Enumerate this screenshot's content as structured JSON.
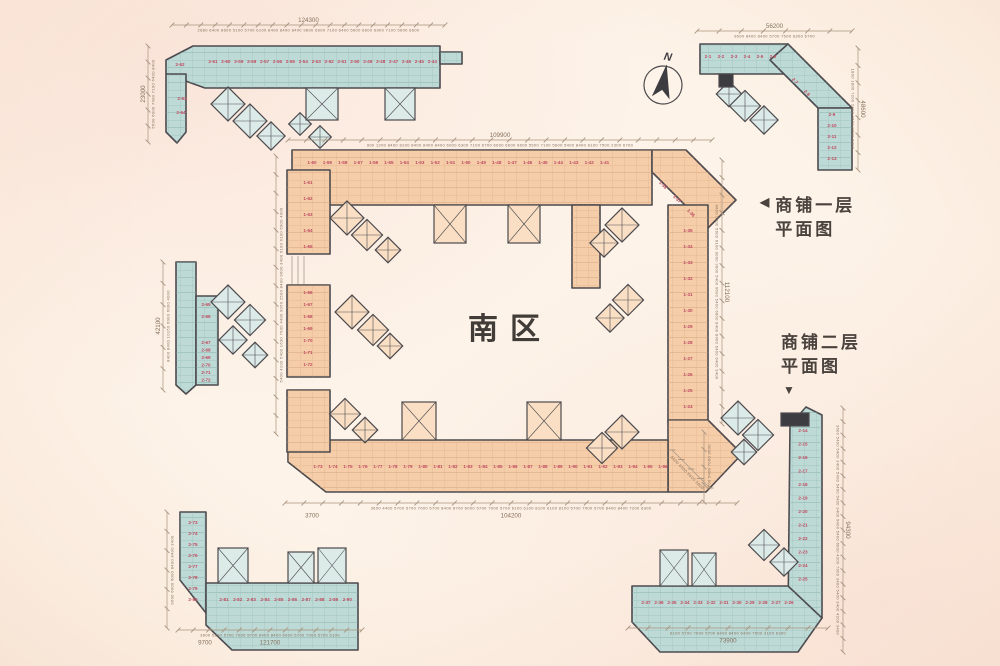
{
  "palette": {
    "teal_fill": "#bedad6",
    "teal_line": "#7ea9a4",
    "orange_fill": "#f5cda9",
    "orange_line": "#cf9d74",
    "teal_tower": "#dcebe8",
    "orange_tower": "#fadfc4",
    "wall": "#4c4a4e",
    "dark": "#3d3c40",
    "dim_text": "#86715d",
    "dim_line": "#a8937e",
    "unit_label": "#c04b60",
    "title": "#413c38"
  },
  "annotations": {
    "center_label": "南区",
    "legend1": {
      "arrow": "◀",
      "line1": "商铺一层",
      "line2": "平面图"
    },
    "legend2": {
      "line1": "商铺二层",
      "line2": "平面图",
      "arrow": "▼"
    },
    "compass_n": "N"
  },
  "plan": {
    "compass": {
      "x": 663,
      "y": 85,
      "r": 19,
      "tilt": 10
    },
    "extra_lines": [
      [
        292,
        256,
        292,
        284
      ],
      [
        298,
        256,
        298,
        284
      ],
      [
        304,
        256,
        304,
        284
      ]
    ],
    "buildings": [
      {
        "name": "north-strip-second-floor",
        "color": "teal",
        "parts": [
          "193,46 440,46 440,88 205,88 166,74 166,60",
          "440,52 462,52 462,64 440,64",
          "166,74 186,74 186,132 177,143 166,132"
        ],
        "towers": [
          {
            "x": 228,
            "y": 104,
            "s": 24,
            "a": 45
          },
          {
            "x": 250,
            "y": 121,
            "s": 24,
            "a": 45
          },
          {
            "x": 271,
            "y": 136,
            "s": 20,
            "a": 45
          },
          {
            "x": 300,
            "y": 124,
            "s": 16,
            "a": 45
          },
          {
            "x": 320,
            "y": 137,
            "s": 16,
            "a": 45
          },
          {
            "x": 306,
            "y": 88,
            "w": 32,
            "h": 32
          },
          {
            "x": 385,
            "y": 88,
            "w": 30,
            "h": 32
          }
        ],
        "label_rows": [
          {
            "x0": 213,
            "y0": 63,
            "dx": 12.9,
            "dy": 0,
            "labels": [
              "2-61",
              "2-60",
              "2-59",
              "2-58",
              "2-57",
              "2-56",
              "2-55",
              "2-54",
              "2-53",
              "2-52",
              "2-51",
              "2-50",
              "2-49",
              "2-48",
              "2-47",
              "2-46",
              "2-45",
              "2-44"
            ]
          }
        ],
        "unit_labels": [
          {
            "t": "2-62",
            "x": 180,
            "y": 66
          },
          {
            "t": "2-63",
            "x": 182,
            "y": 100
          },
          {
            "t": "2-64",
            "x": 181,
            "y": 114
          }
        ],
        "dims": [
          {
            "x1": 172,
            "y1": 25,
            "x2": 445,
            "y2": 25,
            "total": "124300",
            "segs": "2680 6400 8600 5100 5700 6100 8400 8400 8400 9600 6900 7100 6400 5600 6600 6900 7100 5600 6600"
          },
          {
            "x1": 148,
            "y1": 142,
            "x2": 148,
            "y2": 46,
            "total": "23000",
            "segs": "5600 6000 7400 7100 6400 8400"
          }
        ]
      },
      {
        "name": "northeast-wing-second-floor",
        "color": "teal",
        "parts": [
          "700,44 788,44 788,74 700,74",
          "788,44 852,108 818,108 770,60",
          "818,108 852,108 852,170 818,170"
        ],
        "towers": [
          {
            "x": 729,
            "y": 94,
            "s": 18,
            "a": 45
          },
          {
            "x": 745,
            "y": 106,
            "s": 22,
            "a": 45
          },
          {
            "x": 764,
            "y": 120,
            "s": 20,
            "a": 45
          },
          {
            "x": 719,
            "y": 74,
            "w": 14,
            "h": 13,
            "dark": true
          }
        ],
        "label_rows": [
          {
            "x0": 708,
            "y0": 58,
            "dx": 13,
            "dy": 0,
            "labels": [
              "2-1",
              "2-2",
              "2-3",
              "2-4",
              "2-5",
              "2-6"
            ]
          },
          {
            "x0": 832,
            "y0": 116,
            "dx": 0,
            "dy": 11,
            "labels": [
              "2-9",
              "2-10",
              "2-11",
              "2-12",
              "2-13"
            ]
          }
        ],
        "unit_labels": [
          {
            "t": "2-7",
            "x": 794,
            "y": 82,
            "a": 45
          },
          {
            "t": "2-8",
            "x": 806,
            "y": 94,
            "a": 45
          }
        ],
        "dims": [
          {
            "x1": 697,
            "y1": 31,
            "x2": 852,
            "y2": 31,
            "total": "56200",
            "segs": "9600 8400 8400 5700 7500 6300 6700"
          },
          {
            "x1": 858,
            "y1": 48,
            "x2": 858,
            "y2": 170,
            "total": "48600",
            "segs": "1800 1800 7200 2400 9600 9600 6300"
          }
        ]
      },
      {
        "name": "central-ring-first-floor",
        "color": "orange",
        "parts": [
          "292,150 652,150 652,205 317,205 292,180",
          "652,150 686,150 736,200 708,228 652,172",
          "668,205 708,205 708,422 668,422",
          "668,420 708,420 742,454 706,492 668,492",
          "310,440 668,440 668,492 326,492 288,462 288,446",
          "287,170 330,170 330,254 287,254",
          "287,285 330,285 330,377 287,377",
          "287,390 330,390 330,452 287,452",
          "572,205 600,205 600,288 572,288"
        ],
        "towers": [
          {
            "x": 347,
            "y": 218,
            "s": 24,
            "a": 45
          },
          {
            "x": 367,
            "y": 235,
            "s": 22,
            "a": 45
          },
          {
            "x": 388,
            "y": 250,
            "s": 18,
            "a": 45
          },
          {
            "x": 434,
            "y": 205,
            "w": 32,
            "h": 38
          },
          {
            "x": 508,
            "y": 205,
            "w": 32,
            "h": 38
          },
          {
            "x": 622,
            "y": 225,
            "s": 24,
            "a": 45
          },
          {
            "x": 604,
            "y": 243,
            "s": 20,
            "a": 45
          },
          {
            "x": 352,
            "y": 312,
            "s": 24,
            "a": 45
          },
          {
            "x": 373,
            "y": 330,
            "s": 22,
            "a": 45
          },
          {
            "x": 390,
            "y": 346,
            "s": 18,
            "a": 45
          },
          {
            "x": 628,
            "y": 300,
            "s": 22,
            "a": 45
          },
          {
            "x": 610,
            "y": 318,
            "s": 20,
            "a": 45
          },
          {
            "x": 622,
            "y": 432,
            "s": 24,
            "a": 45
          },
          {
            "x": 602,
            "y": 448,
            "s": 22,
            "a": 45
          },
          {
            "x": 345,
            "y": 414,
            "s": 22,
            "a": 45
          },
          {
            "x": 365,
            "y": 430,
            "s": 18,
            "a": 45
          },
          {
            "x": 402,
            "y": 402,
            "w": 34,
            "h": 38
          },
          {
            "x": 527,
            "y": 402,
            "w": 34,
            "h": 38
          }
        ],
        "label_rows": [
          {
            "x0": 312,
            "y0": 164,
            "dx": 15.4,
            "dy": 0,
            "labels": [
              "1-60",
              "1-59",
              "1-58",
              "1-57",
              "1-56",
              "1-55",
              "1-54",
              "1-53",
              "1-52",
              "1-51",
              "1-50",
              "1-49",
              "1-48",
              "1-47",
              "1-46",
              "1-45",
              "1-44",
              "1-43",
              "1-42",
              "1-41"
            ]
          },
          {
            "x0": 688,
            "y0": 232,
            "dx": 0,
            "dy": 16,
            "labels": [
              "1-35",
              "1-34",
              "1-33",
              "1-32",
              "1-31",
              "1-30",
              "1-29",
              "1-28",
              "1-27",
              "1-26",
              "1-25",
              "1-24"
            ]
          },
          {
            "x0": 308,
            "y0": 184,
            "dx": 0,
            "dy": 16,
            "labels": [
              "1-61",
              "1-62",
              "1-63",
              "1-64",
              "1-65"
            ]
          },
          {
            "x0": 308,
            "y0": 294,
            "dx": 0,
            "dy": 12,
            "labels": [
              "1-66",
              "1-67",
              "1-68",
              "1-69",
              "1-70",
              "1-71",
              "1-72"
            ]
          },
          {
            "x0": 318,
            "y0": 468,
            "dx": 15,
            "dy": 0,
            "labels": [
              "1-73",
              "1-74",
              "1-75",
              "1-76",
              "1-77",
              "1-78",
              "1-79",
              "1-80",
              "1-81",
              "1-82",
              "1-83",
              "1-84",
              "1-85",
              "1-86",
              "1-87",
              "1-88",
              "1-89",
              "1-90",
              "1-91",
              "1-92",
              "1-93",
              "1-94",
              "1-95",
              "1-96"
            ]
          }
        ],
        "unit_labels": [
          {
            "t": "1-38",
            "x": 662,
            "y": 186,
            "a": 45
          },
          {
            "t": "1-37",
            "x": 676,
            "y": 200,
            "a": 45
          },
          {
            "t": "1-36",
            "x": 690,
            "y": 214,
            "a": 45
          }
        ],
        "dims": [
          {
            "x1": 288,
            "y1": 140,
            "x2": 712,
            "y2": 140,
            "total": "109900",
            "segs": "900 1200 8400 8100 8400 8400 8400 6000 6300 7100 6700 6600 6600 6600 5500 7100 5600 5400 8400 8100 7500 2300 6700"
          },
          {
            "x1": 285,
            "y1": 503,
            "x2": 737,
            "y2": 503,
            "total": "104200",
            "flip": true,
            "total2": {
              "t": "3700",
              "lx": 27
            },
            "segs": "3600 4400 5700 5700 7000 5700 8400 8700 6000 5700 7000 5700 6100 6100 8100 6100 8100 5700 7000 5700 8400 8400 7200 6300"
          },
          {
            "x1": 722,
            "y1": 160,
            "x2": 722,
            "y2": 424,
            "total": "112100",
            "segs": "6600 5400 5600 6100 9000 3600 5400 9600 5400 6600 8400 8400 6400 6400 3400"
          },
          {
            "x1": 276,
            "y1": 434,
            "x2": 276,
            "y2": 156,
            "total": "",
            "segs": "5400 4100 5400 1630 7900 4400 9050 2500 8400 9600 3400 6100 6100 6000 4000"
          },
          {
            "x1": 672,
            "y1": 450,
            "x2": 710,
            "y2": 488,
            "total": "",
            "segs": "5400 6900 6600 2800"
          }
        ]
      },
      {
        "name": "west-strip-second-floor",
        "color": "teal",
        "parts": [
          "176,262 196,262 196,385 186,394 176,385",
          "196,296 218,296 218,385 196,385"
        ],
        "towers": [
          {
            "x": 228,
            "y": 302,
            "s": 24,
            "a": 45
          },
          {
            "x": 250,
            "y": 320,
            "s": 22,
            "a": 45
          },
          {
            "x": 233,
            "y": 340,
            "s": 20,
            "a": 45
          },
          {
            "x": 255,
            "y": 355,
            "s": 18,
            "a": 45
          }
        ],
        "label_rows": [
          {
            "x0": 206,
            "y0": 344,
            "dx": 0,
            "dy": 7.5,
            "labels": [
              "2-67",
              "2-68",
              "2-69",
              "2-70",
              "2-71",
              "2-72"
            ]
          }
        ],
        "unit_labels": [
          {
            "t": "2-65",
            "x": 206,
            "y": 306
          },
          {
            "t": "2-66",
            "x": 206,
            "y": 318
          }
        ],
        "dims": [
          {
            "x1": 163,
            "y1": 390,
            "x2": 163,
            "y2": 262,
            "total": "42100",
            "segs": "8400 8400 10150 6000 6000 4000"
          }
        ]
      },
      {
        "name": "southwest-wing-second-floor",
        "color": "teal",
        "parts": [
          "180,512 206,512 206,613 180,580",
          "206,583 358,583 358,650 232,650 206,625"
        ],
        "towers": [
          {
            "x": 218,
            "y": 548,
            "w": 30,
            "h": 35
          },
          {
            "x": 288,
            "y": 552,
            "w": 26,
            "h": 31
          },
          {
            "x": 318,
            "y": 548,
            "w": 28,
            "h": 35
          }
        ],
        "label_rows": [
          {
            "x0": 193,
            "y0": 524,
            "dx": 0,
            "dy": 11,
            "labels": [
              "2-73",
              "2-74",
              "2-75",
              "2-76",
              "2-77",
              "2-78",
              "2-79",
              "2-80"
            ]
          },
          {
            "x0": 224,
            "y0": 601,
            "dx": 13.7,
            "dy": 0,
            "labels": [
              "2-81",
              "2-82",
              "2-83",
              "2-84",
              "2-85",
              "2-86",
              "2-87",
              "2-88",
              "2-89",
              "2-90"
            ]
          }
        ],
        "unit_labels": [],
        "dims": [
          {
            "x1": 167,
            "y1": 628,
            "x2": 167,
            "y2": 512,
            "total": "",
            "segs": "9600 6000 6000 8400 8400 3400"
          },
          {
            "x1": 178,
            "y1": 630,
            "x2": 362,
            "y2": 630,
            "total": "121700",
            "flip": true,
            "total2": {
              "t": "9700",
              "lx": 27
            },
            "segs": "3600 5200 5700 7000 5700 8400 8400 6000 5700 7000 5700 6100"
          }
        ]
      },
      {
        "name": "southeast-wing-second-floor",
        "color": "teal",
        "parts": [
          "790,425 806,407 822,415 822,618 788,618",
          "632,586 788,586 822,618 798,652 660,652 632,622"
        ],
        "towers": [
          {
            "x": 738,
            "y": 418,
            "s": 24,
            "a": 45
          },
          {
            "x": 758,
            "y": 435,
            "s": 22,
            "a": 45
          },
          {
            "x": 744,
            "y": 452,
            "s": 18,
            "a": 45
          },
          {
            "x": 764,
            "y": 545,
            "s": 22,
            "a": 45
          },
          {
            "x": 784,
            "y": 562,
            "s": 20,
            "a": 45
          },
          {
            "x": 660,
            "y": 550,
            "w": 28,
            "h": 36
          },
          {
            "x": 692,
            "y": 553,
            "w": 24,
            "h": 33
          },
          {
            "x": 781,
            "y": 413,
            "w": 28,
            "h": 13,
            "dark": true
          }
        ],
        "label_rows": [
          {
            "x0": 803,
            "y0": 432,
            "dx": 0,
            "dy": 13.5,
            "labels": [
              "2-14",
              "2-15",
              "2-16",
              "2-17",
              "2-18",
              "2-19",
              "2-20",
              "2-21",
              "2-22",
              "2-23",
              "2-24",
              "2-25"
            ]
          },
          {
            "x0": 646,
            "y0": 604,
            "dx": 13,
            "dy": 0,
            "labels": [
              "2-37",
              "2-36",
              "2-35",
              "2-34",
              "2-33",
              "2-32",
              "2-31",
              "2-30",
              "2-29",
              "2-28",
              "2-27",
              "2-26"
            ]
          }
        ],
        "unit_labels": [],
        "dims": [
          {
            "x1": 628,
            "y1": 628,
            "x2": 828,
            "y2": 628,
            "total": "73900",
            "flip": true,
            "segs": "6100 5700 7000 5700 8400 8400 6400 7500 3100 6300"
          },
          {
            "x1": 843,
            "y1": 408,
            "x2": 843,
            "y2": 652,
            "total": "94300",
            "segs": "3600 5400 5400 3400 5400 5400 5400 3400 5400 5400 6000 4200 7000 3400 5400 3400 4200 3400"
          },
          {
            "x1": 704,
            "y1": 502,
            "x2": 704,
            "y2": 432,
            "total": "",
            "segs": "5700 5400 7000 3600"
          }
        ]
      }
    ]
  }
}
